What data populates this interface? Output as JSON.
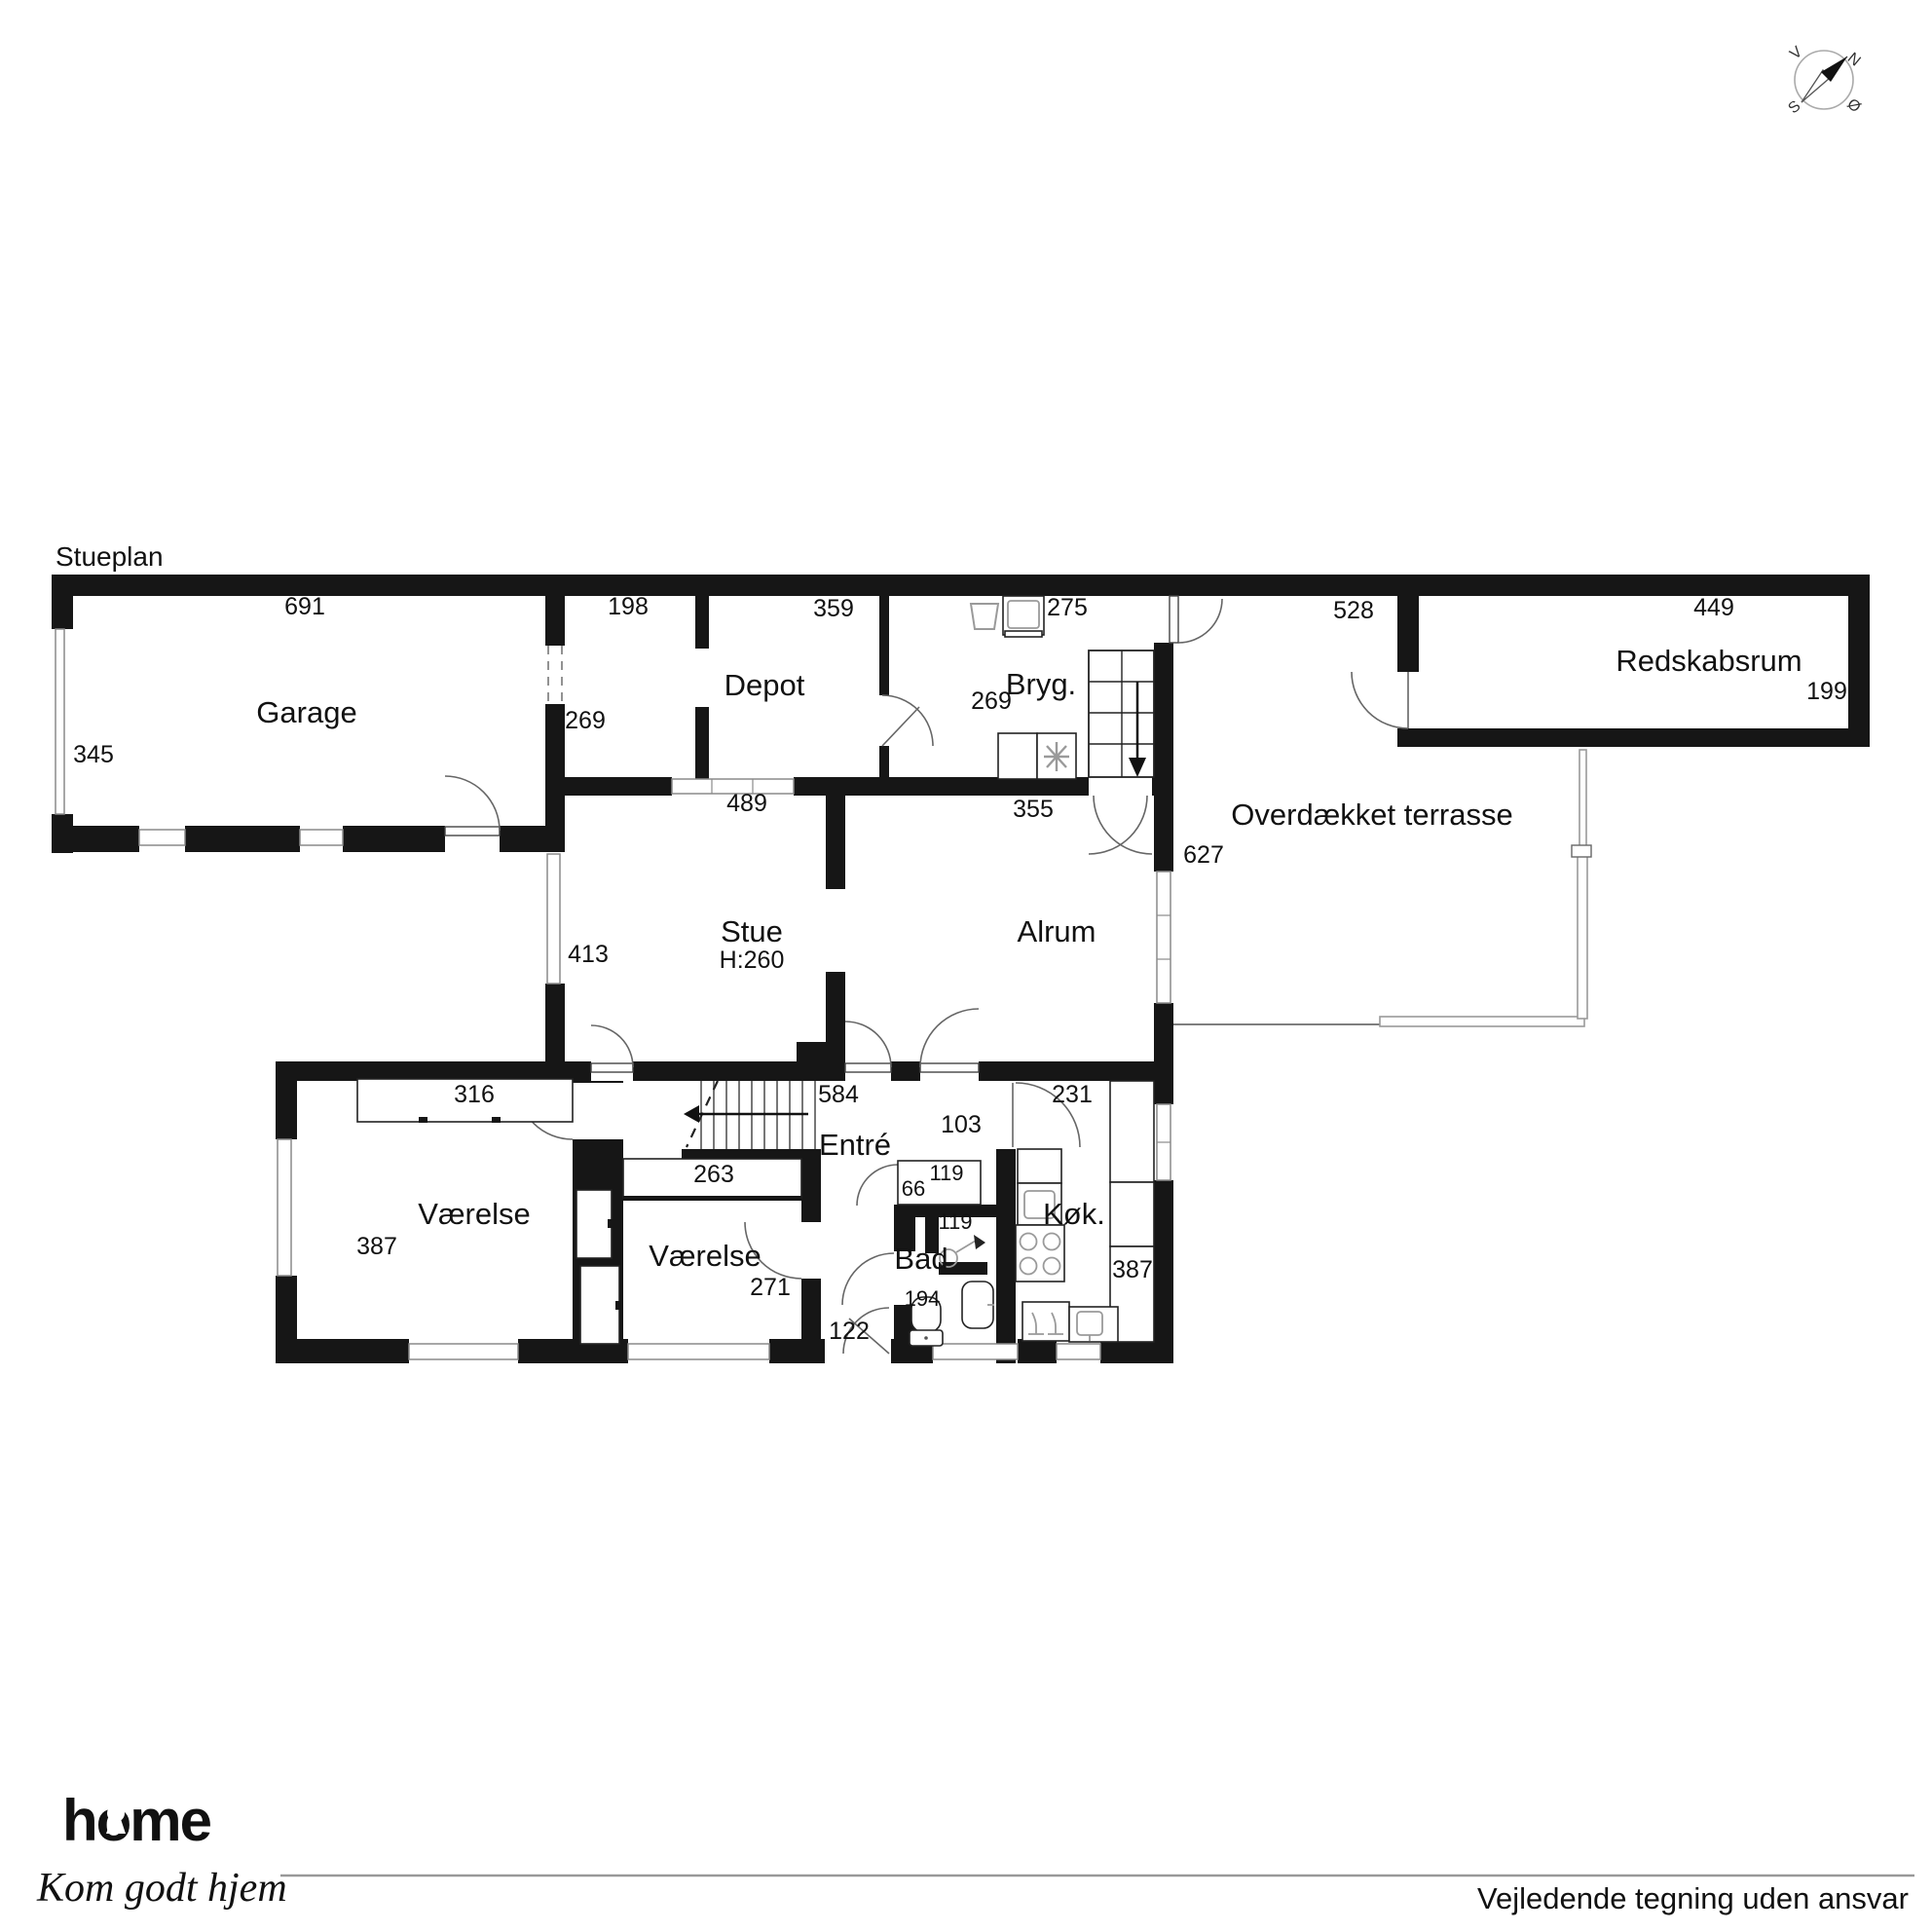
{
  "page": {
    "plan_title": "Stueplan",
    "disclaimer": "Vejledende tegning uden ansvar"
  },
  "branding": {
    "logo": "home",
    "tagline": "Kom godt hjem",
    "brand_color": "#e2231a"
  },
  "compass": {
    "north": "N",
    "south": "S",
    "east": "Ø",
    "west": "V"
  },
  "colors": {
    "wall": "#161616",
    "window_line": "#8a8a8a"
  },
  "rooms": {
    "garage": {
      "label": "Garage",
      "dim_width": "691",
      "dim_depth": "345"
    },
    "depot": {
      "label": "Depot",
      "dim_width": "359",
      "dim_anteroom_width": "198",
      "dim_anteroom_depth": "269",
      "dim_south_wall": "489"
    },
    "bryggers": {
      "label": "Bryg.",
      "dim_north": "275",
      "dim_door": "269",
      "dim_south_wall": "355"
    },
    "redskabsrum": {
      "label": "Redskabsrum",
      "dim_width": "449",
      "dim_depth": "199"
    },
    "terrasse": {
      "label": "Overdækket terrasse",
      "dim_north": "528",
      "dim_west": "627"
    },
    "stue": {
      "label": "Stue",
      "ceiling_height": "H:260",
      "dim_west": "413"
    },
    "alrum": {
      "label": "Alrum"
    },
    "vaerelse_1": {
      "label": "Værelse",
      "dim_wardrobe": "316",
      "dim_west": "387"
    },
    "vaerelse_2": {
      "label": "Værelse",
      "dim_wardrobe": "263",
      "dim_east": "271"
    },
    "entre": {
      "label": "Entré",
      "dim_width": "584",
      "dim_door": "103",
      "dim_wardrobe_width": "119",
      "dim_wardrobe_depth": "66",
      "dim_back_door": "122"
    },
    "bad": {
      "label": "Bad",
      "dim_shower": "119",
      "dim_width": "194"
    },
    "koekken": {
      "label": "Køk.",
      "dim_north": "231",
      "dim_counter": "387"
    }
  }
}
